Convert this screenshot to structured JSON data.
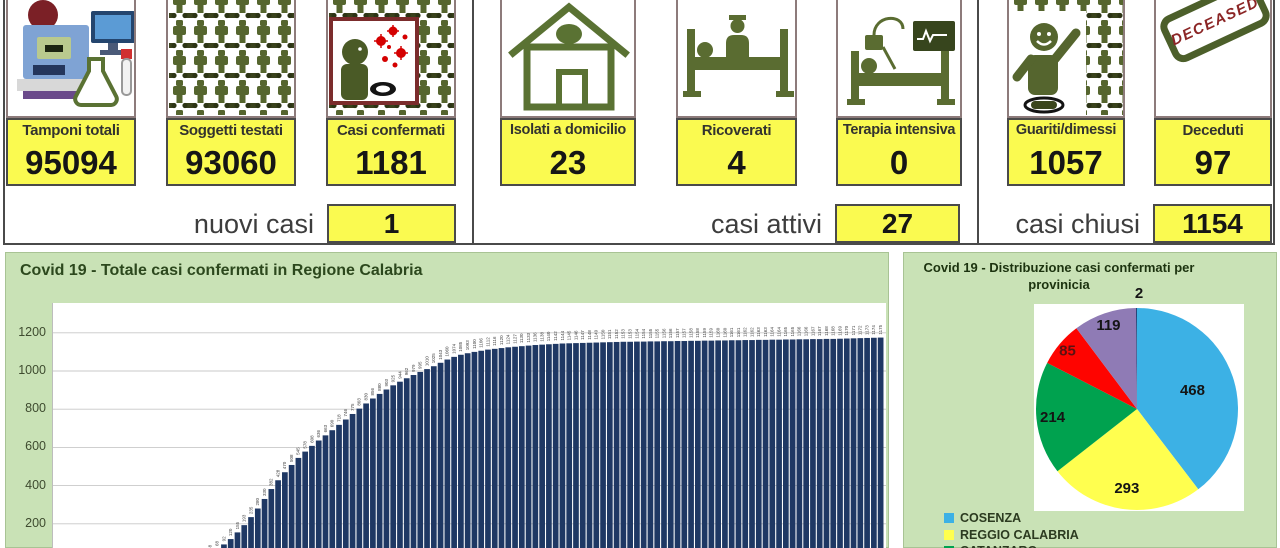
{
  "summary": {
    "cards": [
      {
        "label": "Tamponi totali",
        "value": "95094",
        "icon": "lab-analyzer-icon"
      },
      {
        "label": "Soggetti testati",
        "value": "93060",
        "icon": "people-crowd-icon"
      },
      {
        "label": "Casi confermati",
        "value": "1181",
        "icon": "infected-person-icon"
      },
      {
        "label": "Isolati a domicilio",
        "value": "23",
        "icon": "house-icon"
      },
      {
        "label": "Ricoverati",
        "value": "4",
        "icon": "hospital-bed-icon"
      },
      {
        "label": "Terapia intensiva",
        "value": "0",
        "icon": "icu-bed-icon"
      },
      {
        "label": "Guariti/dimessi",
        "value": "1057",
        "icon": "recovered-person-icon"
      },
      {
        "label": "Deceduti",
        "value": "97",
        "icon": "deceased-stamp-icon"
      }
    ],
    "footers": [
      {
        "label": "nuovi casi",
        "value": "1"
      },
      {
        "label": "casi attivi",
        "value": "27"
      },
      {
        "label": "casi chiusi",
        "value": "1154"
      }
    ],
    "stamp_text": "DECEASED"
  },
  "colors": {
    "value_box_bg": "#fafa50",
    "panel_bg": "#c9e2b6",
    "icon_green": "#55652e",
    "bar_color": "#1F3864"
  },
  "chart_data": [
    {
      "type": "bar",
      "title": "Covid 19 - Totale casi confermati in Regione Calabria",
      "xlabel": "",
      "ylabel": "",
      "yticks": [
        200,
        400,
        600,
        800,
        1000,
        1200
      ],
      "ylim": [
        0,
        1300
      ],
      "grid": true,
      "x_labels_visible": false,
      "bar_color": "#1F3864",
      "values": [
        1,
        1,
        2,
        2,
        3,
        3,
        4,
        5,
        6,
        8,
        10,
        13,
        17,
        23,
        33,
        48,
        68,
        92,
        120,
        155,
        193,
        235,
        280,
        330,
        382,
        428,
        470,
        508,
        545,
        578,
        608,
        636,
        663,
        690,
        718,
        746,
        775,
        803,
        830,
        856,
        880,
        903,
        925,
        944,
        962,
        979,
        995,
        1010,
        1025,
        1043,
        1060,
        1074,
        1085,
        1093,
        1100,
        1106,
        1112,
        1116,
        1120,
        1124,
        1127,
        1130,
        1133,
        1136,
        1138,
        1140,
        1142,
        1144,
        1145,
        1146,
        1147,
        1148,
        1149,
        1150,
        1151,
        1152,
        1153,
        1153,
        1154,
        1154,
        1155,
        1155,
        1156,
        1156,
        1157,
        1157,
        1158,
        1158,
        1159,
        1159,
        1160,
        1160,
        1161,
        1161,
        1162,
        1162,
        1163,
        1163,
        1164,
        1164,
        1165,
        1165,
        1166,
        1166,
        1167,
        1167,
        1168,
        1168,
        1169,
        1170,
        1171,
        1172,
        1173,
        1174,
        1175
      ]
    },
    {
      "type": "pie",
      "title": "Covid 19 - Distribuzione casi confermati per provinicia",
      "title_line1": "Covid 19 - Distribuzione casi confermati per",
      "title_line2": "provinicia",
      "slices": [
        {
          "label": "COSENZA",
          "value": 468,
          "color": "#3CB1E5"
        },
        {
          "label": "REGGIO CALABRIA",
          "value": 293,
          "color": "#FFFF4F"
        },
        {
          "label": "CATANZARO",
          "value": 214,
          "color": "#00A24F"
        },
        {
          "label": "",
          "value": 85,
          "color": "#FE0400"
        },
        {
          "label": "",
          "value": 119,
          "color": "#8F7BB5"
        },
        {
          "label": "",
          "value": 2,
          "color": "#264478"
        }
      ],
      "legend": [
        {
          "label": "COSENZA",
          "color": "#3CB1E5"
        },
        {
          "label": "REGGIO CALABRIA",
          "color": "#FFFF4F"
        },
        {
          "label": "CATANZARO",
          "color": "#00A24F"
        }
      ],
      "legend_position": "bottom-left",
      "label_radius_fractions": [
        0.58,
        0.79,
        0.84,
        0.9,
        0.88,
        0
      ],
      "label_colors": [
        "#141414",
        "#141414",
        "#141414",
        "#5a1212",
        "#141414",
        "#141414"
      ],
      "external_label": {
        "x": 105,
        "y": -6
      }
    }
  ]
}
